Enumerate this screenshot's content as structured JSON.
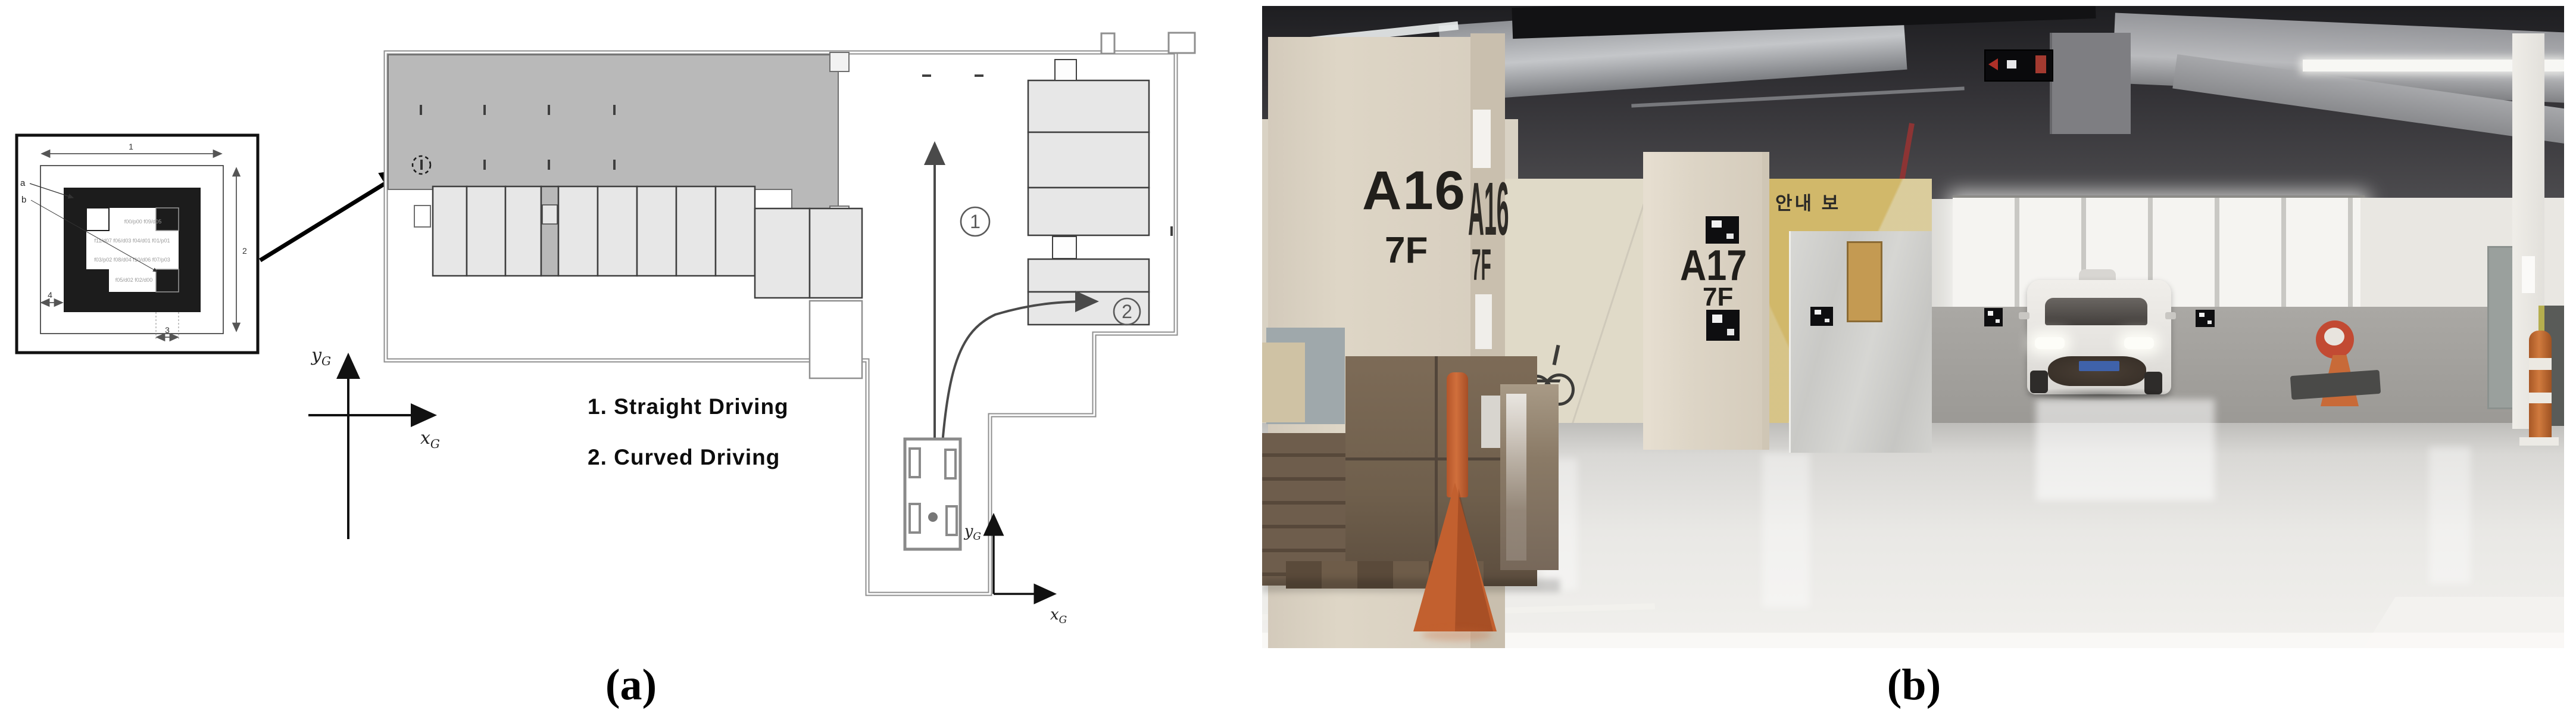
{
  "figure": {
    "caption_a": "(a)",
    "caption_b": "(b)",
    "legend": {
      "item1": "1. Straight  Driving",
      "item2": "2. Curved  Driving"
    },
    "paths": {
      "straight_num": "1",
      "curved_num": "2"
    },
    "axes": {
      "x_letter": "x",
      "y_letter": "y",
      "sub": "G"
    },
    "marker_diagram": {
      "dim1": "1",
      "dim2": "2",
      "dim3": "3",
      "dim4": "4",
      "label_a": "a",
      "label_b": "b",
      "code_rows": {
        "r1": "f00/p00   f09/d05",
        "r2": "f11/d07  f06/d03  f04/d01  f01/p01",
        "r3": "f03/p02  f08/d04  f10/d06  f07/p03",
        "r4": "f05/d02  f02/d00"
      }
    },
    "colors": {
      "plan_gray": "#b9b9b9",
      "stall_gray": "#e6e6e6",
      "path_stroke": "#4a4a4a"
    }
  },
  "photo": {
    "pillar_a16": {
      "id": "A16",
      "floor": "7F"
    },
    "pillar_a16_side": {
      "id": "A16",
      "floor": "7F"
    },
    "pillar_a17": {
      "id": "A17",
      "floor": "7F"
    },
    "korean_wall_sign": "안내 보",
    "colors": {
      "cone_orange": "#c2602f",
      "pillar_cream": "#dbd3c3",
      "lower_wall_gray": "#a3a19e"
    }
  }
}
